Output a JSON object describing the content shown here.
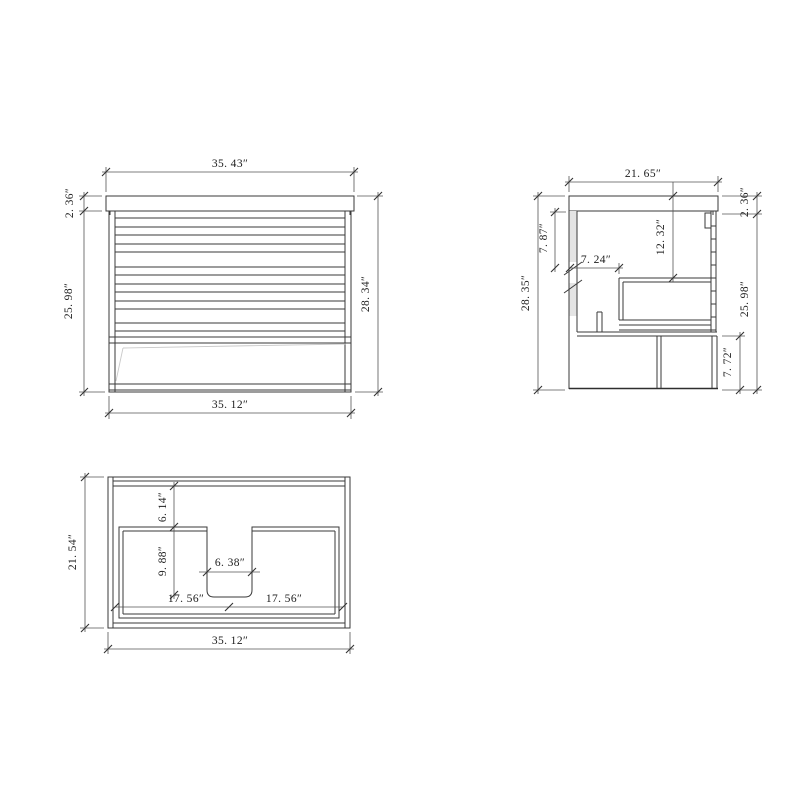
{
  "front_view": {
    "dims": {
      "top_width": "35. 43″",
      "left_top": "2. 36″",
      "left_body": "25. 98″",
      "right_total": "28. 34″",
      "bottom_width": "35. 12″"
    }
  },
  "side_view": {
    "dims": {
      "top_depth": "21. 65″",
      "left_total": "28. 35″",
      "left_upper": "7. 87″",
      "inner_depth": "7. 24″",
      "inner_height": "12. 32″",
      "right_top": "2. 36″",
      "right_body": "25. 98″",
      "right_bottom": "7. 72″"
    }
  },
  "top_view": {
    "dims": {
      "left_depth": "21. 54″",
      "inner_top_offset": "6. 14″",
      "notch_depth": "9. 88″",
      "notch_width": "6. 38″",
      "bottom_left_half": "17. 56″",
      "bottom_right_half": "17. 56″",
      "bottom_width": "35. 12″"
    }
  }
}
